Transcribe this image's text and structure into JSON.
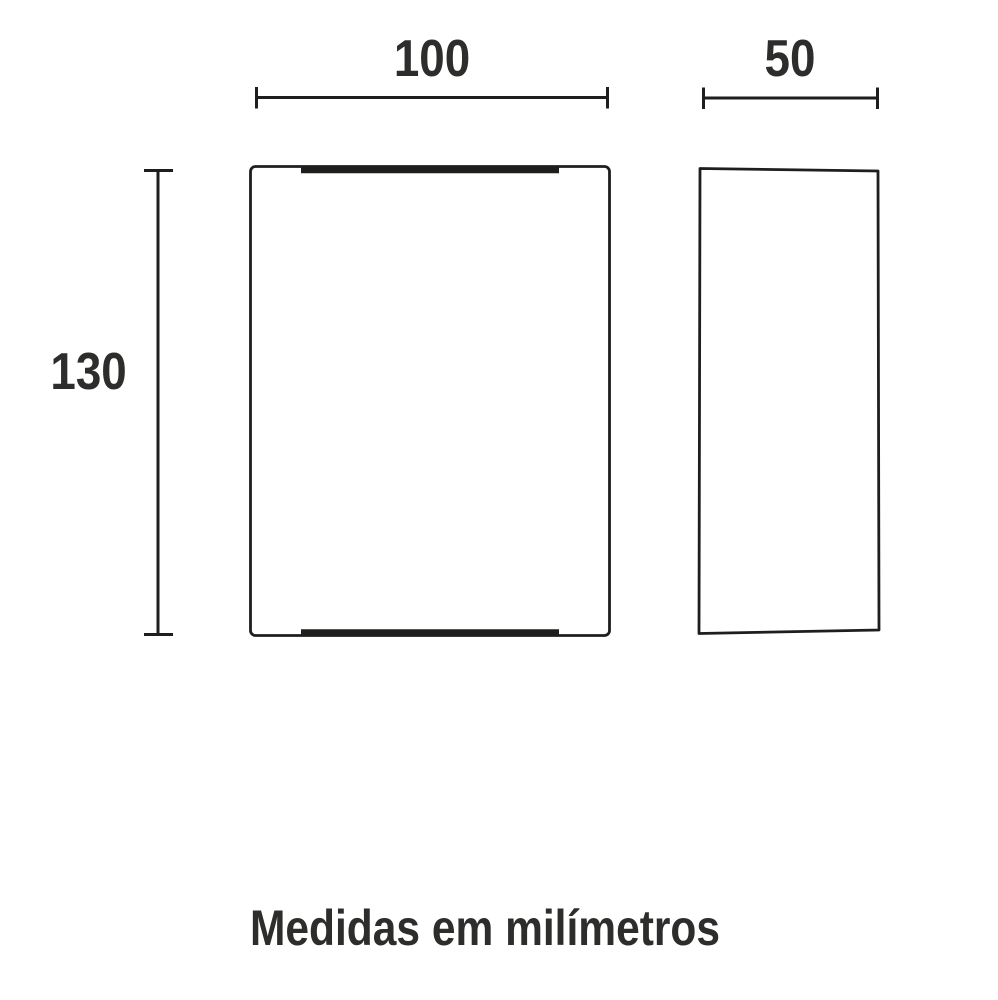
{
  "diagram": {
    "caption": "Medidas em milímetros",
    "front_view": {
      "width_label": "100",
      "height_label": "130"
    },
    "side_view": {
      "depth_label": "50"
    }
  },
  "colors": {
    "line": "#1e1e1c",
    "text": "#2d2d2b",
    "background": "#ffffff"
  }
}
